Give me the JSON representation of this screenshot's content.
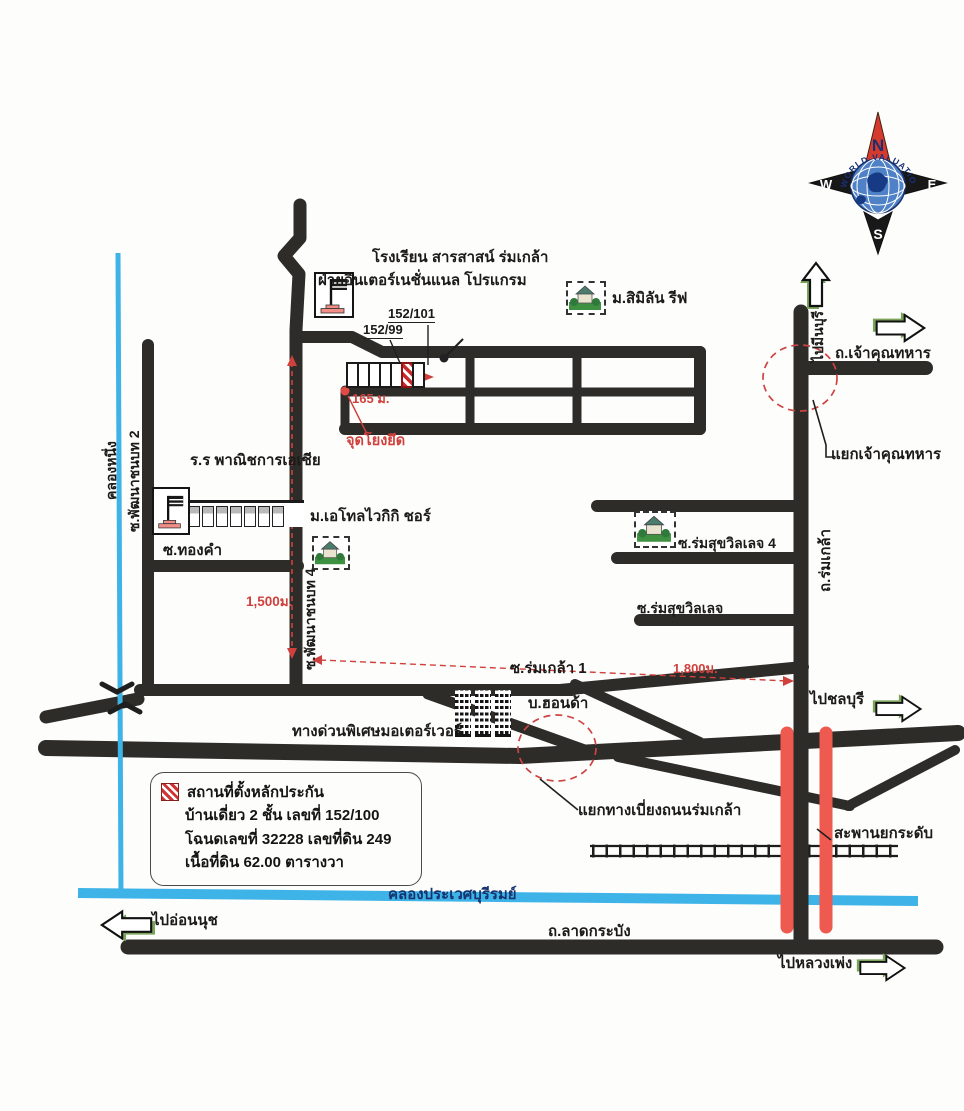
{
  "labels": {
    "school_sarasas_1": "โรงเรียน สารสาสน์ ร่มเกล้า",
    "school_sarasas_2": "ฝ่ายอินเตอร์เนชั่นแนล โปรแกรม",
    "addr_152_101": "152/101",
    "addr_152_99": "152/99",
    "similan": "ม.สิมิลัน รีฟ",
    "dist_165": "165 ม.",
    "anchor_point": "จุดโยงยึด",
    "school_asia": "ร.ร พาณิชการเอเชีย",
    "soi_thongkham": "ซ.ทองคำ",
    "atoll": "ม.เอโทลไวกิกิ ชอร์",
    "canal_left": "คลองหนึ่ง",
    "soi_pattana2": "ซ.พัฒนาชนบท 2",
    "soi_pattana4": "ซ.พัฒนาชนบท 4",
    "dist_1500": "1,500ม.",
    "dist_1800": "1,800ม.",
    "soi_romsuk4": "ซ.ร่มสุขวิลเลจ 4",
    "soi_romsuk": "ซ.ร่มสุขวิลเลจ",
    "soi_romklao1": "ซ.ร่มเกล้า 1",
    "to_minburi": "ไปมีนบุรี",
    "rd_chaokhun": "ถ.เจ้าคุณทหาร",
    "yaek_chaokhun": "แยกเจ้าคุณทหาร",
    "rd_romklao": "ถ.ร่มเกล้า",
    "honda": "บ.ฮอนด้า",
    "motorway": "ทางด่วนพิเศษมอเตอร์เวอร์",
    "yaek_bypass": "แยกทางเบี่ยงถนนร่มเกล้า",
    "to_chonburi": "ไปชลบุรี",
    "elevated_bridge": "สะพานยกระดับ",
    "canal_prawet": "คลองประเวศบุรีรมย์",
    "to_onnut": "ไปอ่อนนุช",
    "rd_latkrabang": "ถ.ลาดกระบัง",
    "to_luangphaeng": "ไปหลวงเพ่ง"
  },
  "legend": {
    "title": "สถานที่ตั้งหลักประกัน",
    "line_house": "บ้านเดี่ยว 2 ชั้น  เลขที่ 152/100",
    "line_deed": "โฉนดเลขที่ 32228 เลขที่ดิน 249",
    "line_area": "เนื้อที่ดิน 62.00 ตารางวา"
  },
  "compass": {
    "n": "N",
    "e": "E",
    "s": "S",
    "w": "W",
    "brand": "WORLD VALUATION"
  },
  "colors": {
    "road_black": "#2e2c29",
    "canal_blue": "#3eb3e8",
    "bridge_red": "#ee5a50",
    "measure_red": "#d0403c",
    "canal_text_navy": "#15336e",
    "arrow_shadow_green": "#7aa35b",
    "compass_north_red": "#d63a2f",
    "globe_blue": "#4f81c6"
  },
  "icons": {
    "school_flag": "school-flag-icon",
    "village_house": "village-house-icon",
    "office_building": "office-building-icon",
    "compass_rose": "compass-rose-icon",
    "direction_arrow": "direction-arrow-icon",
    "railway": "railway-track-icon",
    "subject_hatch": "subject-property-hatch-icon"
  }
}
